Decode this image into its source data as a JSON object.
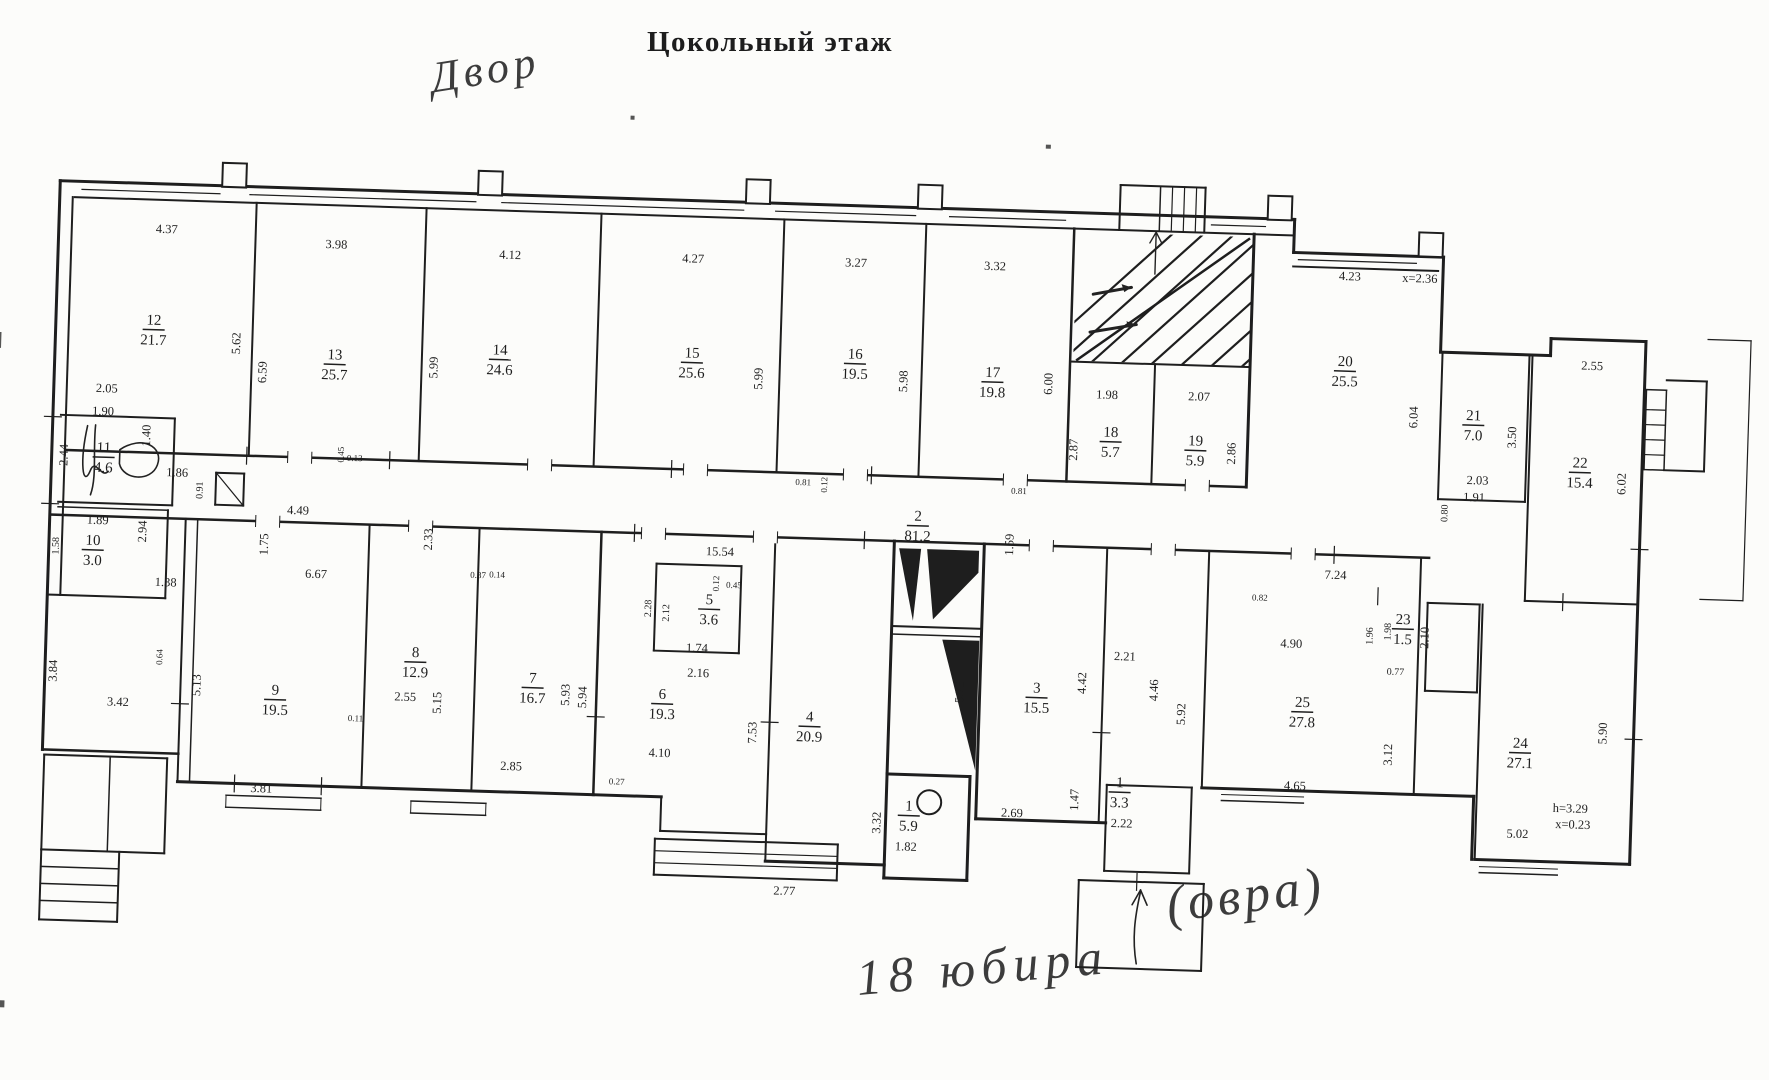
{
  "title": "Цокольный этаж",
  "handwriting": {
    "top": "Двор",
    "bottom_a": "18 юбира",
    "bottom_b": "(овра)"
  },
  "plan": {
    "rooms": [
      {
        "n": "12",
        "a": "21.7",
        "x": 158,
        "y": 326
      },
      {
        "n": "13",
        "a": "25.7",
        "x": 340,
        "y": 355
      },
      {
        "n": "14",
        "a": "24.6",
        "x": 505,
        "y": 345
      },
      {
        "n": "15",
        "a": "25.6",
        "x": 697,
        "y": 342
      },
      {
        "n": "16",
        "a": "19.5",
        "x": 860,
        "y": 338
      },
      {
        "n": "17",
        "a": "19.8",
        "x": 998,
        "y": 352
      },
      {
        "n": "18",
        "a": "5.7",
        "x": 1118,
        "y": 408
      },
      {
        "n": "19",
        "a": "5.9",
        "x": 1203,
        "y": 414
      },
      {
        "n": "20",
        "a": "25.5",
        "x": 1350,
        "y": 330
      },
      {
        "n": "21",
        "a": "7.0",
        "x": 1480,
        "y": 380
      },
      {
        "n": "22",
        "a": "15.4",
        "x": 1588,
        "y": 424
      },
      {
        "n": "11",
        "a": "4.6",
        "x": 112,
        "y": 455
      },
      {
        "n": "10",
        "a": "3.0",
        "x": 104,
        "y": 548
      },
      {
        "n": "9",
        "a": "19.5",
        "x": 291,
        "y": 692
      },
      {
        "n": "8",
        "a": "12.9",
        "x": 430,
        "y": 650
      },
      {
        "n": "7",
        "a": "16.7",
        "x": 548,
        "y": 672
      },
      {
        "n": "6",
        "a": "19.3",
        "x": 678,
        "y": 684
      },
      {
        "n": "5",
        "a": "3.6",
        "x": 722,
        "y": 588
      },
      {
        "n": "4",
        "a": "20.9",
        "x": 826,
        "y": 702
      },
      {
        "n": "3",
        "a": "15.5",
        "x": 1052,
        "y": 666
      },
      {
        "n": "2",
        "a": "81.2",
        "x": 928,
        "y": 498
      },
      {
        "n": "1",
        "a": "5.9",
        "x": 928,
        "y": 788
      },
      {
        "n": "1",
        "a": "3.3",
        "x": 1138,
        "y": 758
      },
      {
        "n": "23",
        "a": "1.5",
        "x": 1416,
        "y": 586
      },
      {
        "n": "25",
        "a": "27.8",
        "x": 1318,
        "y": 672
      },
      {
        "n": "24",
        "a": "27.1",
        "x": 1537,
        "y": 706
      }
    ],
    "dims": [
      {
        "t": "4.37",
        "x": 168,
        "y": 230
      },
      {
        "t": "3.98",
        "x": 338,
        "y": 240
      },
      {
        "t": "4.12",
        "x": 512,
        "y": 245
      },
      {
        "t": "4.27",
        "x": 695,
        "y": 243
      },
      {
        "t": "3.27",
        "x": 858,
        "y": 242
      },
      {
        "t": "3.32",
        "x": 997,
        "y": 241
      },
      {
        "t": "4.23",
        "x": 1352,
        "y": 240
      },
      {
        "t": "x=2.36",
        "x": 1422,
        "y": 240
      },
      {
        "t": "2.55",
        "x": 1597,
        "y": 322
      },
      {
        "t": "5.62",
        "x": 245,
        "y": 338,
        "r": 1
      },
      {
        "t": "6.59",
        "x": 272,
        "y": 366,
        "r": 1
      },
      {
        "t": "5.99",
        "x": 443,
        "y": 356,
        "r": 1
      },
      {
        "t": "5.99",
        "x": 768,
        "y": 357,
        "r": 1
      },
      {
        "t": "5.98",
        "x": 913,
        "y": 355,
        "r": 1
      },
      {
        "t": "6.00",
        "x": 1058,
        "y": 353,
        "r": 1
      },
      {
        "t": "1.98",
        "x": 1113,
        "y": 366
      },
      {
        "t": "2.07",
        "x": 1205,
        "y": 365
      },
      {
        "t": "2.87",
        "x": 1085,
        "y": 418,
        "r": 1
      },
      {
        "t": "2.86",
        "x": 1243,
        "y": 417,
        "r": 1
      },
      {
        "t": "6.04",
        "x": 1424,
        "y": 375,
        "r": 1
      },
      {
        "t": "3.50",
        "x": 1523,
        "y": 392,
        "r": 1
      },
      {
        "t": "6.02",
        "x": 1634,
        "y": 435,
        "r": 1
      },
      {
        "t": "2.03",
        "x": 1486,
        "y": 440
      },
      {
        "t": "1.91",
        "x": 1483,
        "y": 457
      },
      {
        "t": "0.80",
        "x": 1457,
        "y": 470,
        "r": 1,
        "s": 10
      },
      {
        "t": "2.05",
        "x": 113,
        "y": 391
      },
      {
        "t": "1.90",
        "x": 110,
        "y": 414
      },
      {
        "t": "2.44",
        "x": 76,
        "y": 455,
        "r": 1
      },
      {
        "t": "1.40",
        "x": 158,
        "y": 433,
        "r": 1
      },
      {
        "t": "1.86",
        "x": 186,
        "y": 473
      },
      {
        "t": "0.91",
        "x": 212,
        "y": 486,
        "r": 1,
        "s": 10
      },
      {
        "t": "1.89",
        "x": 108,
        "y": 523
      },
      {
        "t": "2.94",
        "x": 157,
        "y": 529,
        "r": 1
      },
      {
        "t": "1.58",
        "x": 70,
        "y": 546,
        "r": 1,
        "s": 10
      },
      {
        "t": "4.49",
        "x": 308,
        "y": 507
      },
      {
        "t": "1.75",
        "x": 279,
        "y": 538,
        "r": 1
      },
      {
        "t": "2.33",
        "x": 443,
        "y": 528,
        "r": 1
      },
      {
        "t": "1.38",
        "x": 178,
        "y": 583
      },
      {
        "t": "3.84",
        "x": 72,
        "y": 671,
        "r": 1
      },
      {
        "t": "3.42",
        "x": 134,
        "y": 704
      },
      {
        "t": "6.67",
        "x": 328,
        "y": 570
      },
      {
        "t": "5.13",
        "x": 216,
        "y": 681,
        "r": 1
      },
      {
        "t": "3.81",
        "x": 280,
        "y": 786
      },
      {
        "t": "0.64",
        "x": 177,
        "y": 654,
        "r": 1,
        "s": 9
      },
      {
        "t": "0.11",
        "x": 372,
        "y": 712,
        "s": 9
      },
      {
        "t": "2.55",
        "x": 421,
        "y": 690
      },
      {
        "t": "5.15",
        "x": 457,
        "y": 691,
        "r": 1
      },
      {
        "t": "5.93",
        "x": 585,
        "y": 679,
        "r": 1
      },
      {
        "t": "5.94",
        "x": 602,
        "y": 681,
        "r": 1
      },
      {
        "t": "2.85",
        "x": 529,
        "y": 756
      },
      {
        "t": "0.27",
        "x": 635,
        "y": 767,
        "s": 9
      },
      {
        "t": "4.10",
        "x": 677,
        "y": 738
      },
      {
        "t": "2.28",
        "x": 664,
        "y": 590,
        "r": 1,
        "s": 10
      },
      {
        "t": "2.12",
        "x": 682,
        "y": 594,
        "r": 1,
        "s": 10
      },
      {
        "t": "1.74",
        "x": 711,
        "y": 632
      },
      {
        "t": "2.16",
        "x": 713,
        "y": 657
      },
      {
        "t": "0.45",
        "x": 746,
        "y": 567,
        "s": 9
      },
      {
        "t": "0.12",
        "x": 731,
        "y": 563,
        "r": 1,
        "s": 9
      },
      {
        "t": "15.54",
        "x": 731,
        "y": 535
      },
      {
        "t": "0.87",
        "x": 490,
        "y": 565,
        "s": 9
      },
      {
        "t": "0.14",
        "x": 509,
        "y": 564,
        "s": 9
      },
      {
        "t": "7.53",
        "x": 773,
        "y": 711,
        "r": 1
      },
      {
        "t": "2.77",
        "x": 806,
        "y": 872
      },
      {
        "t": "3.32",
        "x": 900,
        "y": 797,
        "r": 1
      },
      {
        "t": "1.82",
        "x": 926,
        "y": 824
      },
      {
        "t": "2.69",
        "x": 1031,
        "y": 787
      },
      {
        "t": "5.75",
        "x": 979,
        "y": 664,
        "r": 1
      },
      {
        "t": "4.42",
        "x": 1101,
        "y": 651,
        "r": 1
      },
      {
        "t": "2.21",
        "x": 1139,
        "y": 627
      },
      {
        "t": "4.46",
        "x": 1173,
        "y": 656,
        "r": 1
      },
      {
        "t": "5.92",
        "x": 1201,
        "y": 679,
        "r": 1
      },
      {
        "t": "1.59",
        "x": 1024,
        "y": 515,
        "r": 1
      },
      {
        "t": "1.47",
        "x": 1097,
        "y": 768,
        "r": 1
      },
      {
        "t": "2.22",
        "x": 1141,
        "y": 794
      },
      {
        "t": "7.24",
        "x": 1347,
        "y": 539
      },
      {
        "t": "4.90",
        "x": 1305,
        "y": 609
      },
      {
        "t": "1.96",
        "x": 1386,
        "y": 595,
        "r": 1,
        "s": 10
      },
      {
        "t": "1.98",
        "x": 1404,
        "y": 590,
        "r": 1,
        "s": 10
      },
      {
        "t": "2.10",
        "x": 1442,
        "y": 595,
        "r": 1
      },
      {
        "t": "0.77",
        "x": 1410,
        "y": 633,
        "s": 10
      },
      {
        "t": "4.65",
        "x": 1313,
        "y": 751
      },
      {
        "t": "3.12",
        "x": 1409,
        "y": 713,
        "r": 1
      },
      {
        "t": "5.90",
        "x": 1623,
        "y": 685,
        "r": 1
      },
      {
        "t": "h=3.29",
        "x": 1589,
        "y": 765
      },
      {
        "t": "x=0.23",
        "x": 1592,
        "y": 781
      },
      {
        "t": "5.02",
        "x": 1537,
        "y": 792
      },
      {
        "t": "0.81",
        "x": 812,
        "y": 462,
        "s": 9
      },
      {
        "t": "0.12",
        "x": 836,
        "y": 461,
        "r": 1,
        "s": 9
      },
      {
        "t": "0.45",
        "x": 352,
        "y": 446,
        "r": 1,
        "s": 9
      },
      {
        "t": "0.13",
        "x": 363,
        "y": 452,
        "s": 9
      },
      {
        "t": "0.81",
        "x": 1028,
        "y": 464,
        "s": 9
      },
      {
        "t": "0.82",
        "x": 1272,
        "y": 563,
        "s": 9
      }
    ]
  }
}
